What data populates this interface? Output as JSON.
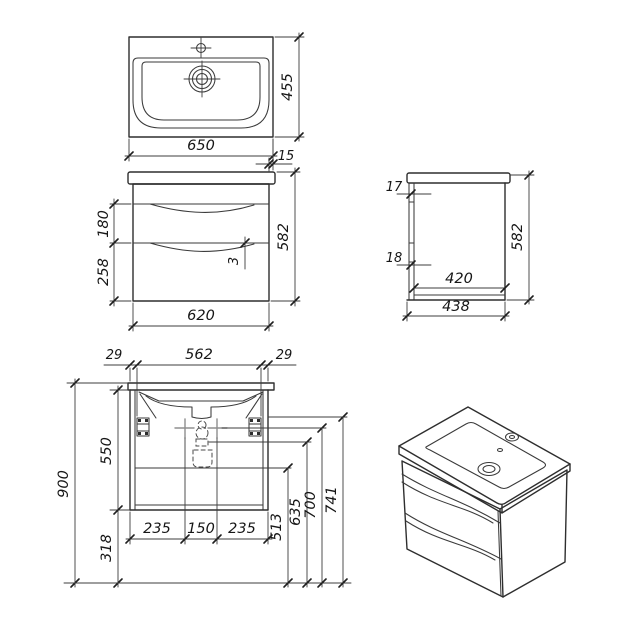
{
  "drawing": {
    "kind": "technical dimension drawing",
    "subject": "wall-hung bathroom vanity unit with washbasin",
    "background": "#ffffff",
    "line_color": "#2e2e2e",
    "marker_color": "#8f8f8f"
  },
  "views": {
    "top": {
      "width": "650",
      "depth": "455",
      "overhang": "15"
    },
    "front": {
      "width": "620",
      "height": "582",
      "drawer_top": "180",
      "drawer_bottom": "258",
      "gap": "3"
    },
    "side": {
      "rail_top": "17",
      "rail_bottom": "18",
      "inner_depth": "420",
      "depth": "438",
      "height": "582"
    },
    "mounting": {
      "offset_left": "29",
      "span": "562",
      "offset_right": "29",
      "total_height": "900",
      "cabinet_height": "550",
      "floor_clearance": "318",
      "fix_left": "235",
      "fix_center": "150",
      "fix_right": "235",
      "h_drawer_line": "513",
      "h_siphon": "635",
      "h_fixing": "700",
      "h_bracket": "741"
    }
  }
}
